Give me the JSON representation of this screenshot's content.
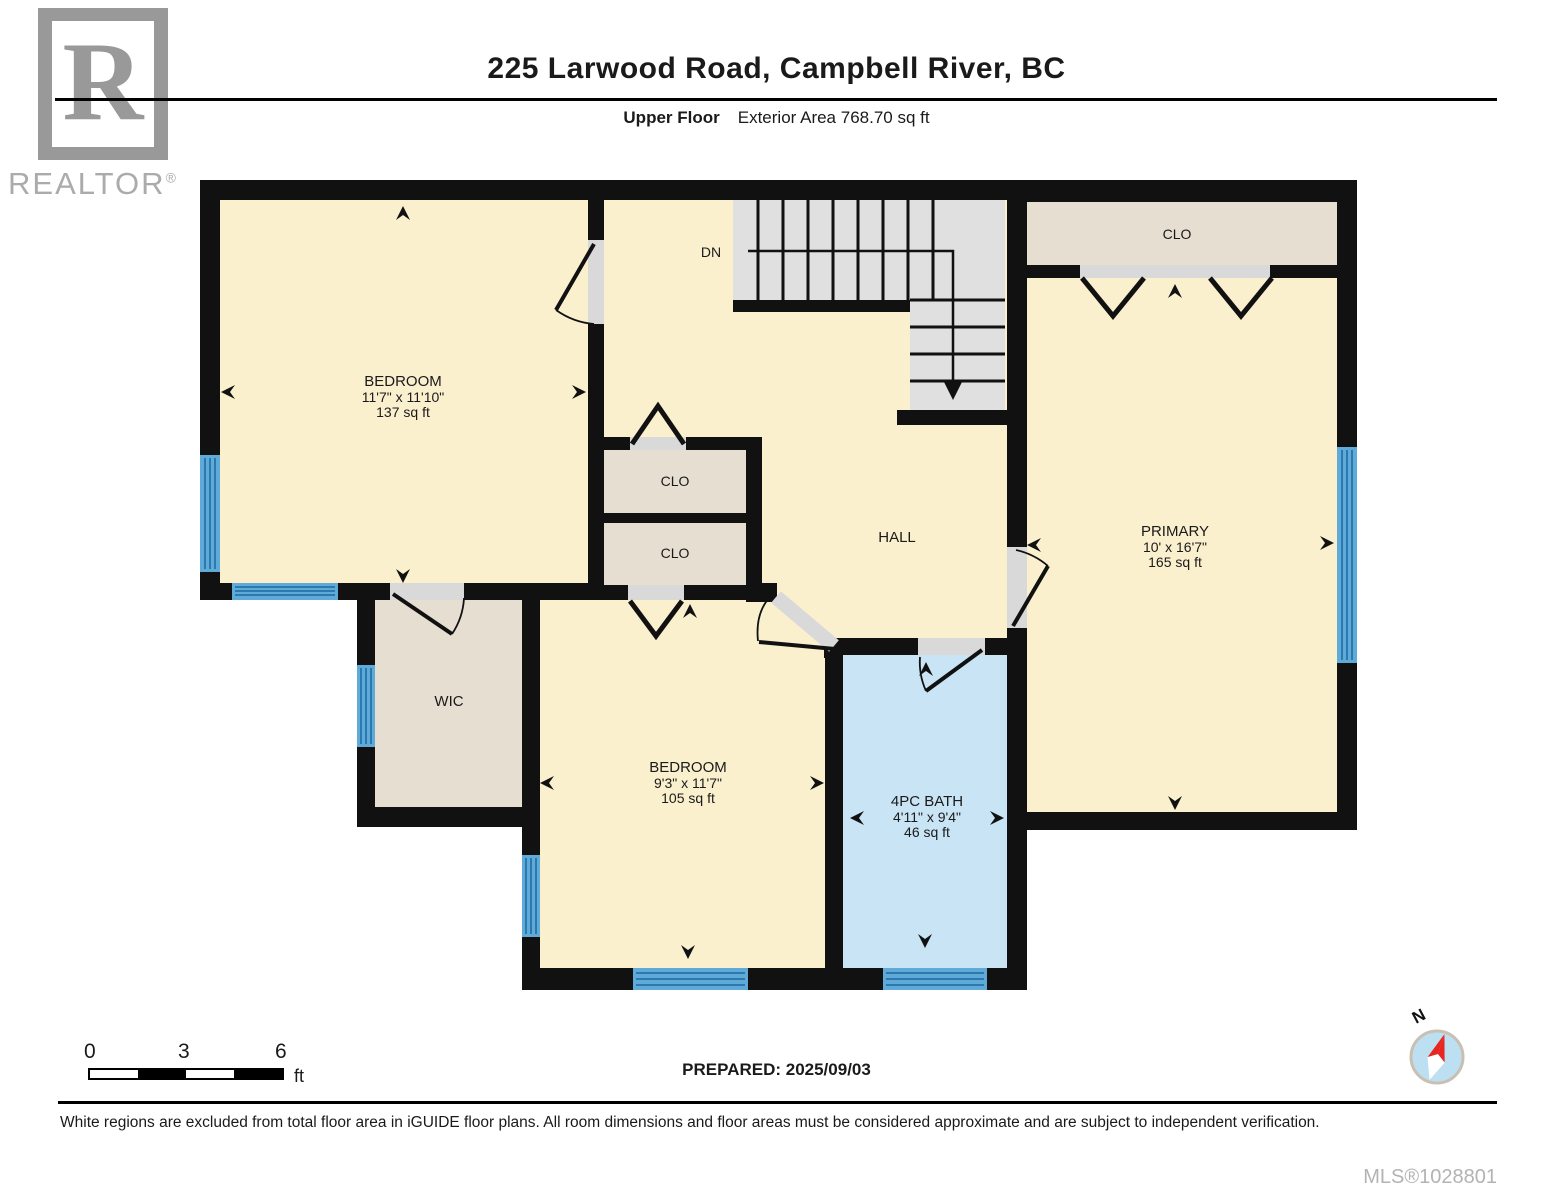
{
  "header": {
    "title": "225 Larwood Road, Campbell River, BC",
    "floor_label": "Upper Floor",
    "area_label": "Exterior Area 768.70 sq ft",
    "logo_letter": "R",
    "logo_word": "REALTOR",
    "logo_reg": "®"
  },
  "rooms": {
    "bedroom1": {
      "name": "BEDROOM",
      "dims": "11'7\" x 11'10\"",
      "area": "137 sq ft"
    },
    "bedroom2": {
      "name": "BEDROOM",
      "dims": "9'3\" x 11'7\"",
      "area": "105 sq ft"
    },
    "primary": {
      "name": "PRIMARY",
      "dims": "10' x 16'7\"",
      "area": "165 sq ft"
    },
    "bath": {
      "name": "4PC BATH",
      "dims": "4'11\" x 9'4\"",
      "area": "46 sq ft"
    },
    "hall": {
      "name": "HALL"
    },
    "wic": {
      "name": "WIC"
    },
    "closet1": {
      "name": "CLO"
    },
    "closet2": {
      "name": "CLO"
    },
    "primary_closet": {
      "name": "CLO"
    },
    "stairs": {
      "name": "DN"
    }
  },
  "scale_bar": {
    "ticks": [
      "0",
      "3",
      "6"
    ],
    "unit": "ft"
  },
  "prepared_label": "PREPARED: 2025/09/03",
  "compass": {
    "north_label": "N"
  },
  "footer": {
    "disclaimer": "White regions are excluded from total floor area in iGUIDE floor plans. All room dimensions and floor areas must be considered approximate and are subject to independent verification.",
    "mls": "MLS®1028801"
  },
  "colors": {
    "wall": "#111111",
    "room_fill": "#FBF0CE",
    "closet_fill": "#E6DED1",
    "bath_fill": "#C9E4F5",
    "window_fill": "#5FAAD8",
    "window_stripe": "#2B7AAD",
    "stair_fill": "#E0E0E0",
    "door_fill": "#D9D9D9",
    "logo_gray": "#999999",
    "mls_gray": "#B3B3B3",
    "compass_blue": "#BCE0F2",
    "compass_red": "#E8251F"
  }
}
